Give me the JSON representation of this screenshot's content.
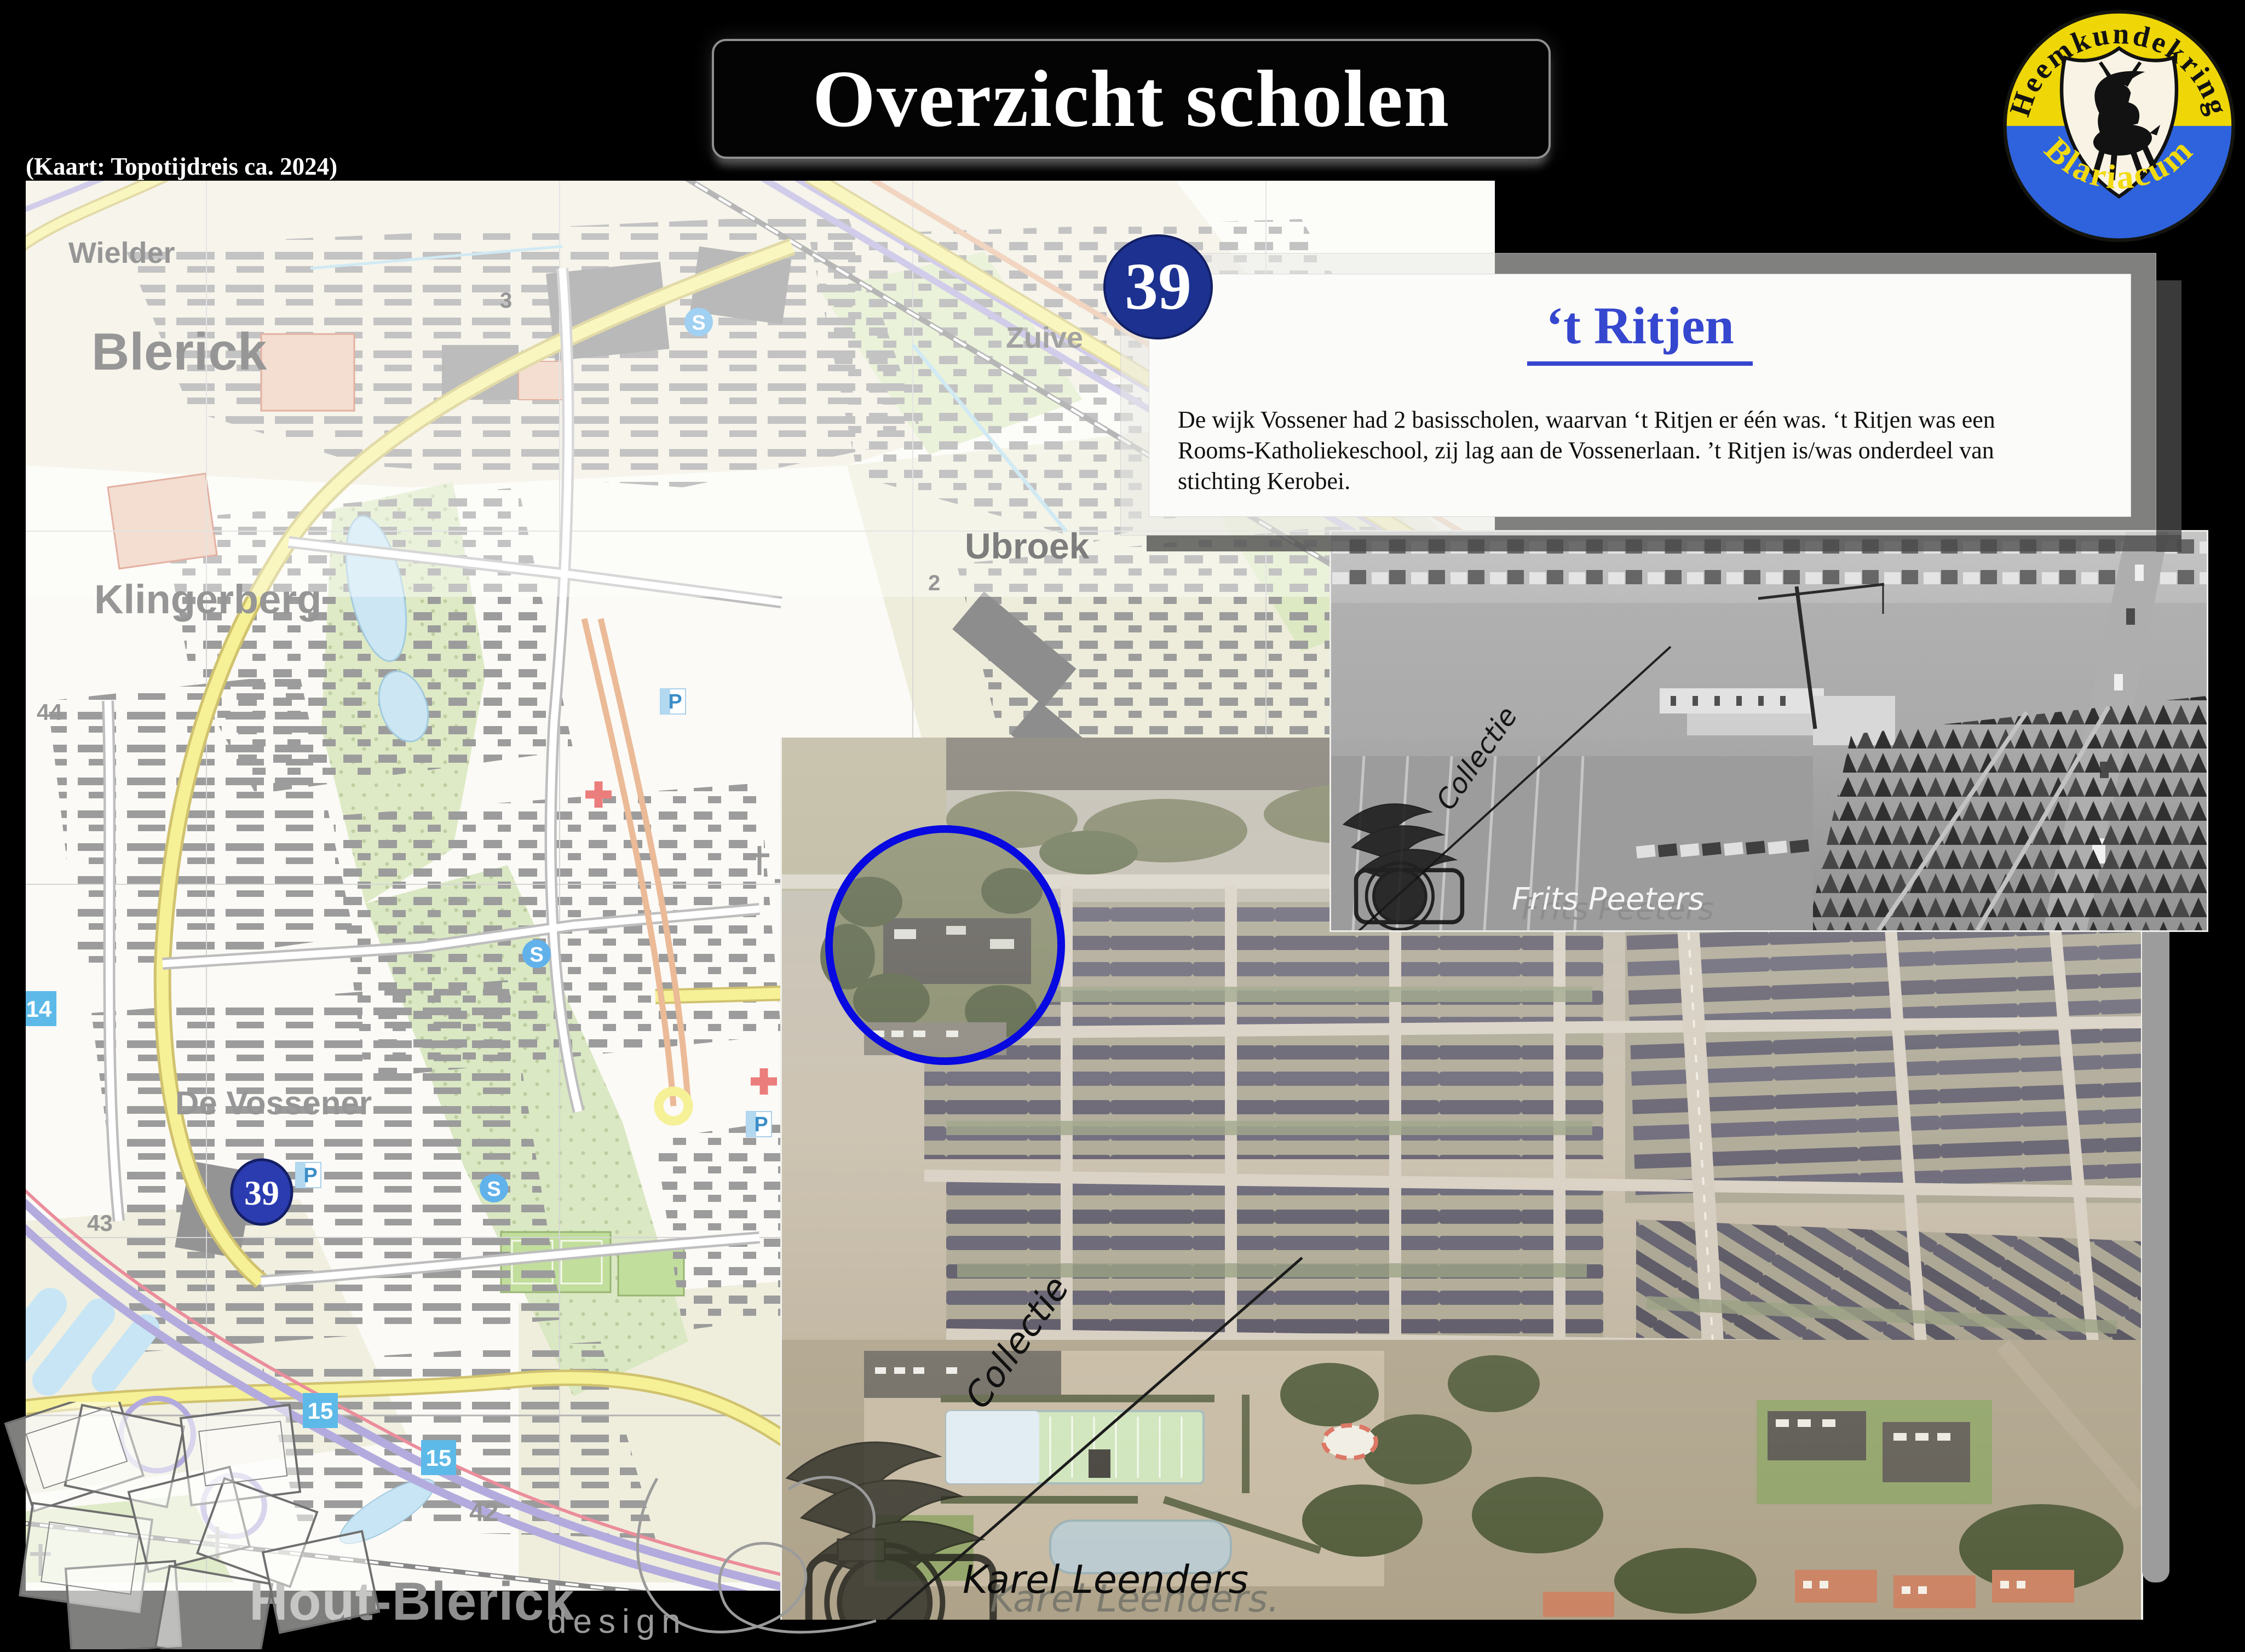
{
  "slide": {
    "title": "Overzicht scholen",
    "map_credit": "(Kaart: Topotijdreis ca. 2024)",
    "badge_number": "39"
  },
  "card": {
    "title": "‘t Ritjen",
    "body_lines": [
      "De wijk Vossener had 2 basisscholen, waarvan ‘t Ritjen er één was. ‘t Ritjen was een",
      "Rooms-Katholiekeschool, zij lag aan de Vossenerlaan. ’t Ritjen is/was onderdeel van",
      "stichting Kerobei."
    ]
  },
  "logo": {
    "top_text": "Heemkundekring",
    "bottom_text": "Blariacum"
  },
  "map": {
    "place_labels": [
      "Wielder",
      "Blerick",
      "Klingerberg",
      "Ubroek",
      "De Vossener",
      "Hout-Blerick",
      "Zuive"
    ],
    "area_numbers": [
      "44",
      "43",
      "42",
      "3",
      "2"
    ],
    "route_shields": [
      "15",
      "15",
      "14"
    ],
    "marker_number": "39",
    "parking_letter": "P",
    "sport_letter": "S"
  },
  "watermarks": {
    "bw_collectie": "Collectie",
    "bw_name": "Frits Peeters",
    "bw_name_echo": "Frits Peeters",
    "color_collectie": "Collectie",
    "color_name": "Karel Leenders",
    "color_name_echo": "Karel Leenders.",
    "designer": "design"
  },
  "colors": {
    "badge_blue": "#1c3190",
    "heading_blue": "#3546cf",
    "circle_blue": "#0808e0",
    "logo_yellow": "#eed607",
    "logo_blue": "#2f63dd",
    "shield_blue": "#45b0e5"
  }
}
